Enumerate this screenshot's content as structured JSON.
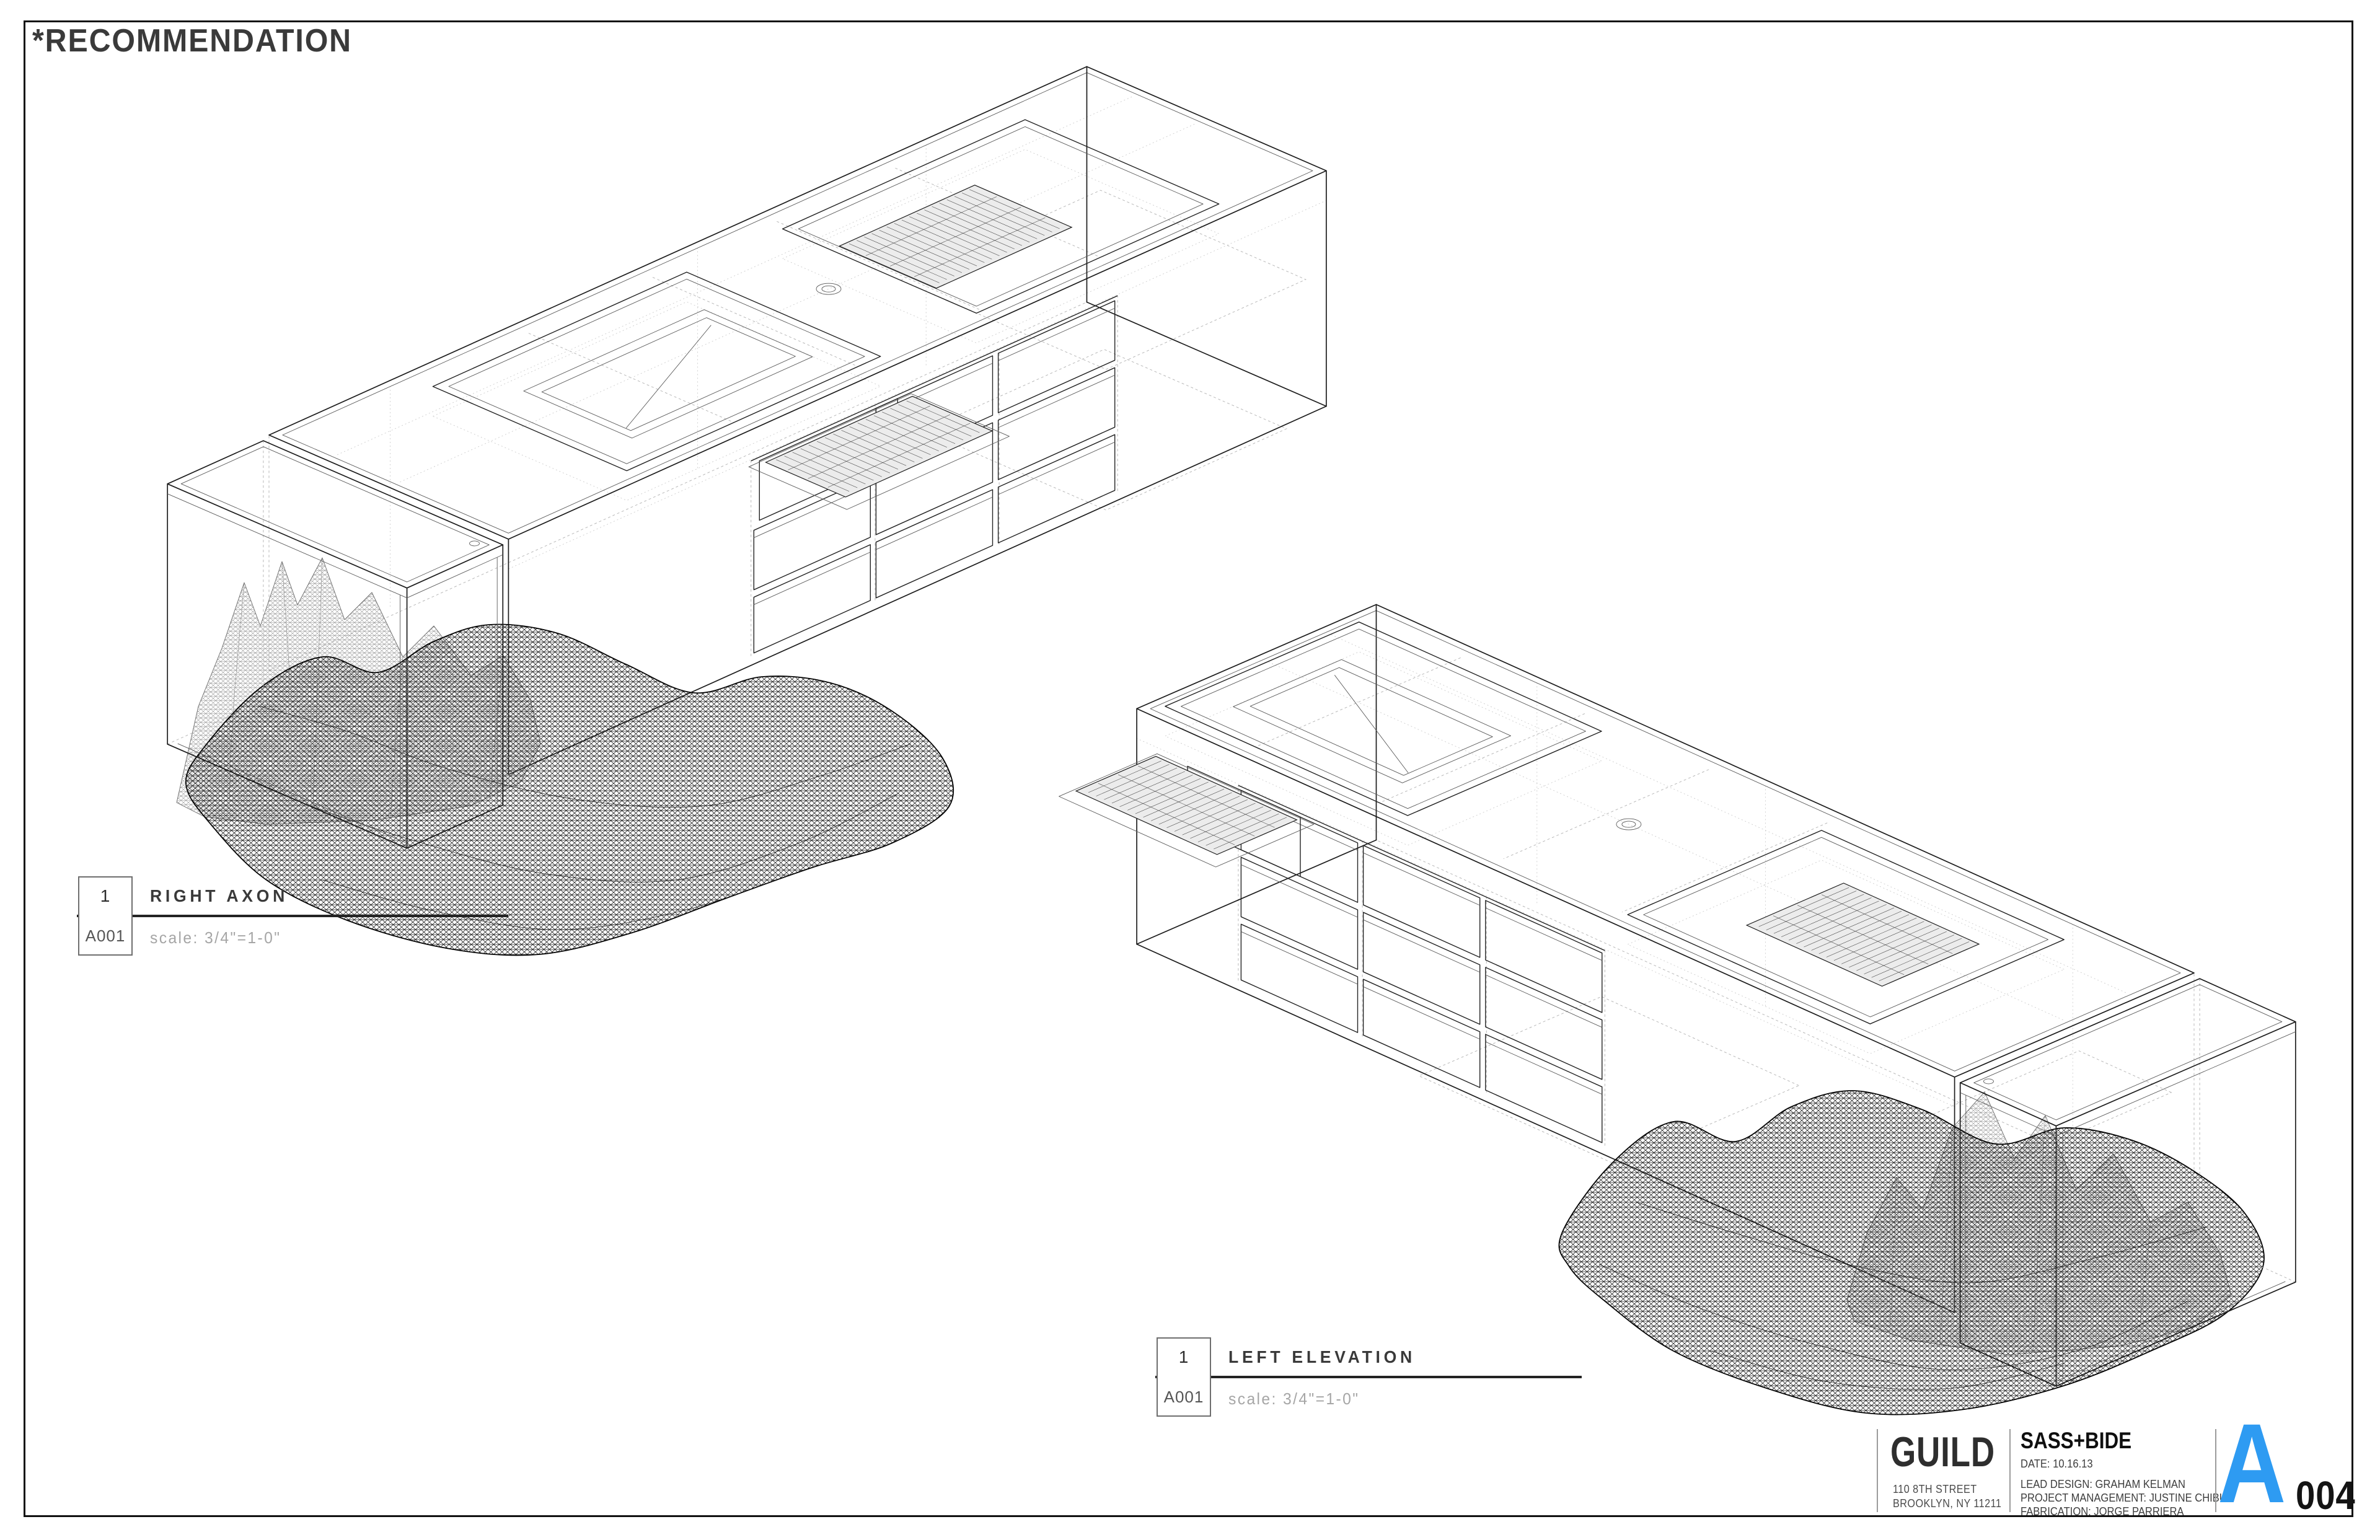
{
  "sheet": {
    "title": "*RECOMMENDATION"
  },
  "viewports": [
    {
      "number": "1",
      "detail_ref": "A001",
      "view_title": "RIGHT AXON",
      "scale_note": "scale: 3/4\"=1-0\""
    },
    {
      "number": "1",
      "detail_ref": "A001",
      "view_title": "LEFT ELEVATION",
      "scale_note": "scale: 3/4\"=1-0\""
    }
  ],
  "title_block": {
    "firm_name": "GUILD",
    "firm_address_line1": "110 8TH STREET",
    "firm_address_line2": "BROOKLYN, NY 11211",
    "project_name": "SASS+BIDE",
    "date_line": "DATE: 10.16.13",
    "credit_lines": [
      "LEAD DESIGN: GRAHAM KELMAN",
      "PROJECT MANAGEMENT: JUSTINE CHIBUK",
      "FABRICATION: JORGE PARRIERA"
    ],
    "sheet_series_letter": "A",
    "sheet_number": "004",
    "accent_color": "#2E9BF2"
  }
}
